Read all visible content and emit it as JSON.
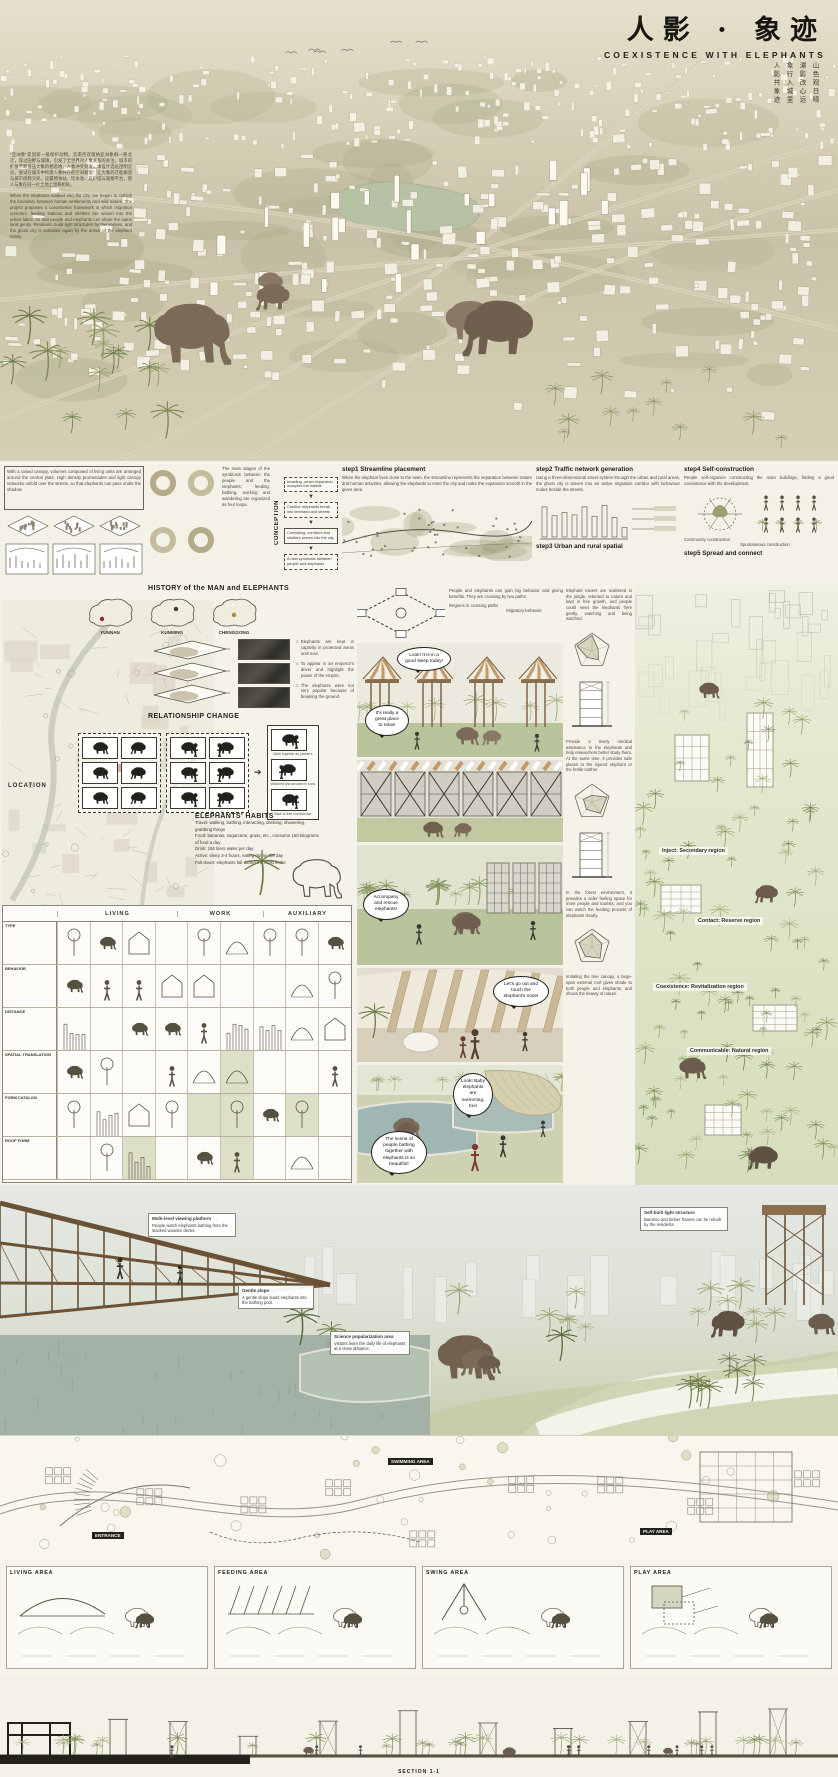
{
  "poster": {
    "title_cn": "人影 · 象迹",
    "title_en": "COEXISTENCE WITH ELEPHANTS",
    "poem_columns": [
      "山色观日晴",
      "潭影改心远",
      "象行入城里",
      "人影共象迹"
    ]
  },
  "intro": {
    "cn": "“亚洲象”是国家一级保护动物。云南西双版纳亚洲象群一路北迁，穿过田野与城镇，引发了全世界对人象关系的关注。城市的扩张不断挤压大象的栖息地，人象冲突频发。本设计选址昆明呈贡，尝试在城市中构建人象共存的空间框架：让大象的迁徙廊道与城市街巷交织，设置喂食站、饮水池、庇护塔与观察平台，使人与象在同一片土地上温和相处。",
    "en": "When the elephants walked into the city, we began to rethink the boundary between human settlements and wild nature. The project proposes a coexistence framework in which migration corridors, feeding stations and shelters are woven into the urban fabric, so that people and elephants can share the same land gently. Residents build light structures by themselves, and the ghost city is activated again by the arrival of the elephant family."
  },
  "steps": {
    "panel1_note": "With a raised canopy, volumes composed of living units are arranged around the central plate. High density promenades and light canopy networks unfold over the streets, so that elephants can pass under the shadow.",
    "rings_note": "The main stages of the symbiosis between the people and the elephants: feeding, bathing, working and wandering are organized as four loops.",
    "conception_label": "CONCEPTION",
    "flow": {
      "box1": "Invading: urban expansion occupies the habitat",
      "box2": "Conflict: elephants break into farmland and streets",
      "box3": "Coexisting: corridors and shelters woven into the city",
      "box4": "A new symbiosis between people and elephants"
    },
    "step1": {
      "title": "step1  Streamline placement",
      "desc": "When the elephant lives close to the town, the streamline represents the separation between nature and human activities, allowing the elephants to enter the city and make the expansion smooth in the given area."
    },
    "step2": {
      "title": "step2  Traffic network generation",
      "desc": "Using a three-dimensional street system through the urban and rural areas, the ghost city is woven into an active migration corridor with behaviour nodes beside the streets."
    },
    "step3": {
      "title": "step3  Urban and rural spatial"
    },
    "step4": {
      "title": "step4  Self-construction",
      "desc": "People self-organize constructing the main buildings, finding a good coexistence with the development."
    },
    "step5": {
      "title": "step5  Spread and connect"
    },
    "legend1": "Community construction",
    "legend2": "Spontaneous construction"
  },
  "history": {
    "header": "HISTORY of the MAN and ELEPHANTS",
    "maps": [
      "YUNNAN",
      "KUNMING",
      "CHENGGONG"
    ],
    "bullets": [
      "Elephants are kept in captivity in protected areas until now.",
      "To appear in an emperor's driver and highlight the power of the empire.",
      "The elephants were not very popular because of breaking the ground."
    ]
  },
  "relationship": {
    "header": "RELATIONSHIP CHANGE",
    "captions": [
      "Work together as partners",
      "Watched and amused in zoos",
      "Back to free coexistence"
    ]
  },
  "habits": {
    "header": "ELEPHANTS'  HABITS",
    "travel": "Travel: walking, bathing, interacting, drinking, showering, grabbing things",
    "lines": [
      "Food: bananas, sugarcane, grass, etc., consume 150 kilograms of food a day",
      "Drink: 150 liters water per day",
      "Active: sleep 3-4 hours, eating during the day",
      "Full-down: elephants fall during the most fertile"
    ]
  },
  "location_label": "LOCATION",
  "middiagrams": {
    "note": "People and elephants can gain big behavior and giving benefits. They are crossing by two paths.",
    "cap1": "Regions in crossing paths",
    "cap2": "Migratory behavior"
  },
  "matrix": {
    "cols": [
      "LIVING",
      "WORK",
      "AUXILIARY"
    ],
    "rows": [
      "TYPE",
      "BEHAVIOR",
      "DISTANCE",
      "SPATIAL TRANSLATION",
      "FORM CATALOG",
      "ROOF FORM"
    ]
  },
  "bubbles": {
    "b1": "Look! It is in a good sleep today!",
    "b2": "It's really a great place to relax!",
    "b3": "Accompany and rescue elephants!",
    "b4": "Let's go out and touch the elephant's nose!",
    "b5": "Look! Baby elephants are swimming, too!",
    "b6": "The scene of people bathing together with elephants is so beautiful!"
  },
  "forest": {
    "intro": "Elephant towers are scattered in the jungle, returned to nature and kept in free growth, and people could meet the elephants here gently, watching and being watched.",
    "regions": [
      "Inject: Secondary region",
      "Contact: Reserve region",
      "Coexistence: Revitalization region",
      "Communicable: Natural region"
    ],
    "notes": [
      "Provide a timely medical assistance to the elephants and help researchers better study them. At the same time, it provides safe places to the injured elephant or the fertile mother.",
      "In the forest environment, it provides a safer feeling space for more people and tourists, and you can watch the feeding process of elephants clearly.",
      "Imitating the tree canopy, a large-span external roof gives shade to both people and elephants, and shows the beauty of nature."
    ]
  },
  "bigview": {
    "annotations": [
      {
        "title": "Multi-level viewing platform",
        "text": "People watch elephants bathing from the stacked wooden decks."
      },
      {
        "title": "Gentle slope",
        "text": "A gentle slope leads elephants into the bathing pool."
      },
      {
        "title": "Science popularization area",
        "text": "Visitors learn the daily life of elephants at a close distance."
      },
      {
        "title": "Self-built light structure",
        "text": "Bamboo and timber frames can be rebuilt by the residents."
      }
    ]
  },
  "siteplan": {
    "labels": [
      "ENTRANCE",
      "SWIMMING AREA",
      "PLAY AREA"
    ]
  },
  "details": {
    "groups": [
      "LIVING AREA",
      "FEEDING AREA",
      "SWING AREA",
      "PLAY AREA"
    ]
  },
  "elevation": {
    "label": "SECTION 1-1"
  }
}
